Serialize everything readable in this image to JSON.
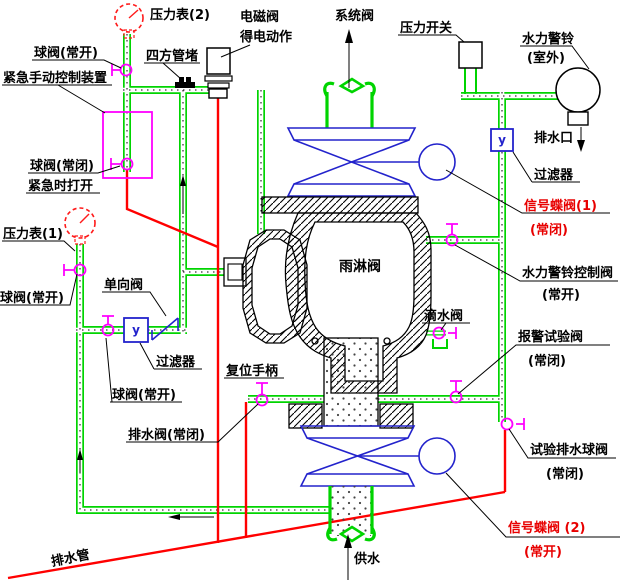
{
  "diagram_type": "deluge-valve-piping-schematic",
  "colors": {
    "pipe_green": "#00d400",
    "drain_red": "#ff0000",
    "valve_magenta": "#ff00ff",
    "symbol_blue": "#2323cc",
    "line_black": "#000000",
    "warning_label_red": "#e80000",
    "gauge_red": "#ff1a1a",
    "background": "#ffffff"
  },
  "labels": {
    "pressure_gauge_2": "压力表(2)",
    "ball_valve_top": "球阀(常开)",
    "square_pipe_plug": "四方管堵",
    "solenoid_valve_l1": "电磁阀",
    "solenoid_valve_l2": "得电动作",
    "system_valve": "系统阀",
    "pressure_switch": "压力开关",
    "alarm_bell_l1": "水力警铃",
    "alarm_bell_l2": "(室外)",
    "emergency_device": "紧急手动控制装置",
    "ball_valve_nc_l1": "球阀(常闭)",
    "ball_valve_nc_l2": "紧急时打开",
    "drain_outlet": "排水口",
    "filter_right": "过滤器",
    "signal_butterfly_1_l1": "信号蝶阀(1)",
    "signal_butterfly_1_l2": "(常闭)",
    "pressure_gauge_1": "压力表(1)",
    "alarm_control_valve_l1": "水力警铃控制阀",
    "alarm_control_valve_l2": "(常开)",
    "deluge_valve": "雨淋阀",
    "check_valve": "单向阀",
    "ball_valve_left": "球阀(常开)",
    "filter_left": "过滤器",
    "drip_valve": "滴水阀",
    "alarm_test_valve_l1": "报警试验阀",
    "alarm_test_valve_l2": "(常闭)",
    "ball_valve_mid": "球阀(常开)",
    "reset_handle": "复位手柄",
    "drain_valve_nc": "排水阀(常闭)",
    "test_drain_valve_l1": "试验排水球阀",
    "test_drain_valve_l2": "(常闭)",
    "signal_butterfly_2_l1": "信号蝶阀 (2)",
    "signal_butterfly_2_l2": "(常开)",
    "drain_pipe": "排水管",
    "water_supply": "供水",
    "filter_symbol": "y"
  }
}
